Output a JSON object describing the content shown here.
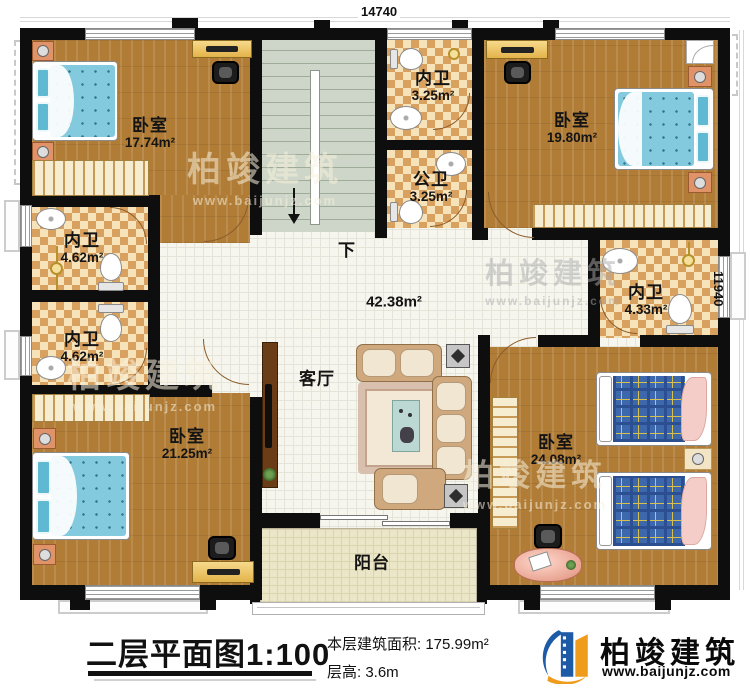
{
  "dimensions": {
    "width_mm": "14740",
    "height_mm": "11940"
  },
  "rooms": {
    "bedroom_top_left": {
      "name": "卧室",
      "area": "17.74m²"
    },
    "bedroom_top_right": {
      "name": "卧室",
      "area": "19.80m²"
    },
    "bedroom_bottom_left": {
      "name": "卧室",
      "area": "21.25m²"
    },
    "bedroom_bottom_right": {
      "name": "卧室",
      "area": "24.08m²"
    },
    "bath_top": {
      "name": "内卫",
      "area": "3.25m²"
    },
    "bath_public": {
      "name": "公卫",
      "area": "3.25m²"
    },
    "bath_left_upper": {
      "name": "内卫",
      "area": "4.62m²"
    },
    "bath_left_lower": {
      "name": "内卫",
      "area": "4.62m²"
    },
    "bath_right": {
      "name": "内卫",
      "area": "4.33m²"
    },
    "hall": {
      "area": "42.38m²"
    },
    "living_room": {
      "name": "客厅"
    },
    "balcony": {
      "name": "阳台"
    }
  },
  "stairs": {
    "down_label": "下"
  },
  "watermark": {
    "brand": "柏竣建筑",
    "website": "www.baijunjz.com"
  },
  "footer": {
    "title": "二层平面图",
    "scale": "1:100",
    "floor_area": "本层建筑面积: 175.99m²",
    "floor_height": "层高: 3.6m",
    "brand": "柏竣建筑",
    "website": "www.baijunjz.com"
  },
  "palette": {
    "wall": "#0e0e0e",
    "wood": "#b07c36",
    "bath_tile": "#d9a160",
    "hall_tile": "#f6f6ef",
    "stair": "#cdd6c8",
    "bed_blue": "#84cade",
    "plaid_blue": "#3d68ac",
    "brand_blue": "#1d5ba6",
    "brand_orange": "#ef9c1c"
  }
}
